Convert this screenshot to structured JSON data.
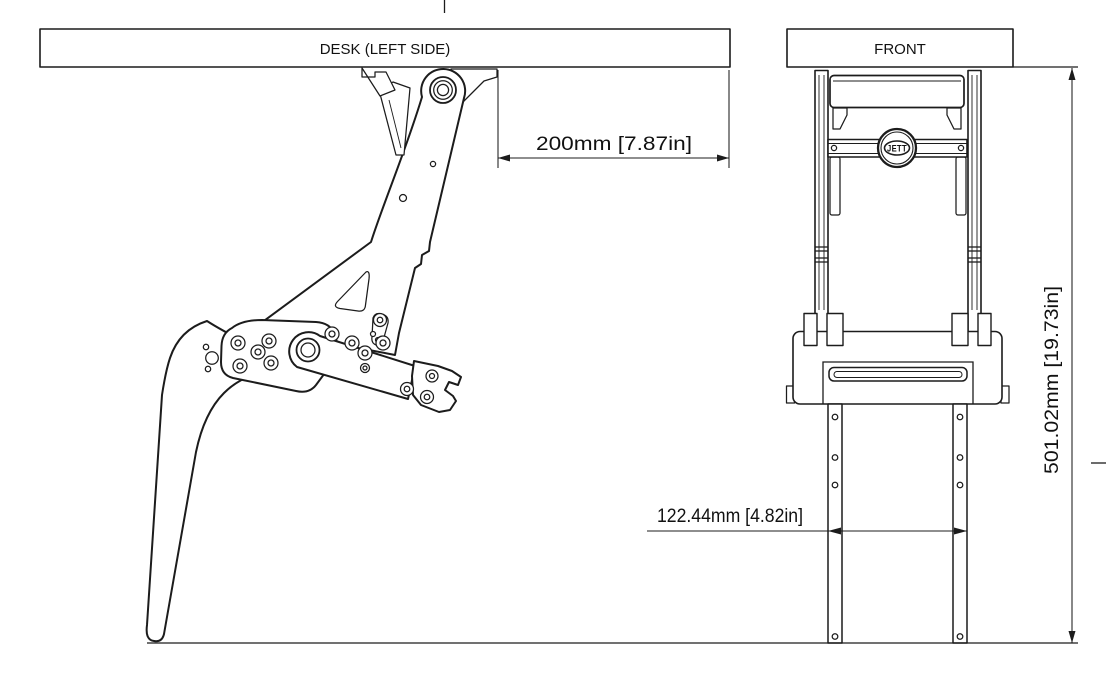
{
  "drawing": {
    "views": {
      "side": {
        "title": "DESK (LEFT SIDE)"
      },
      "front": {
        "title": "FRONT"
      }
    },
    "dimensions": {
      "clamp_to_desk_edge": {
        "label": "200mm [7.87in]",
        "value_mm": 200,
        "value_in": 7.87
      },
      "leg_spacing": {
        "label": "122.44mm [4.82in]",
        "value_mm": 122.44,
        "value_in": 4.82
      },
      "overall_height": {
        "label": "501.02mm [19.73in]",
        "value_mm": 501.02,
        "value_in": 19.73
      }
    },
    "logo": {
      "text": "JETT"
    },
    "colors": {
      "line": "#1c1c1c",
      "background": "#ffffff",
      "text": "#111111"
    }
  }
}
